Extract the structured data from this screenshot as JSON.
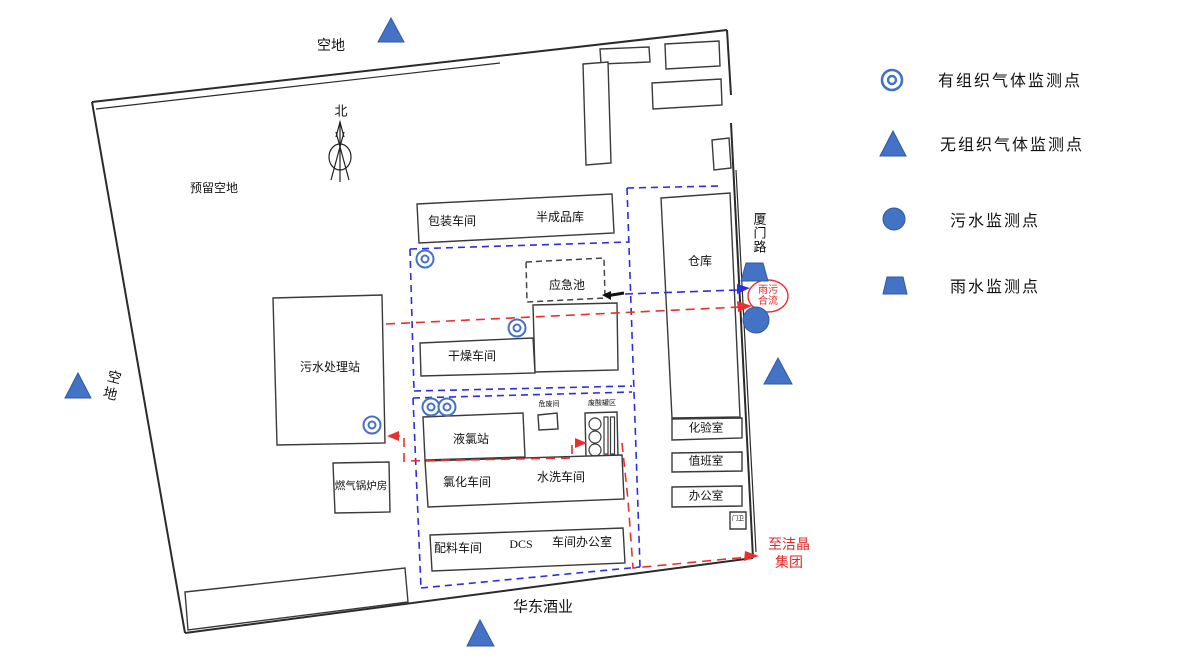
{
  "legend": {
    "items": [
      {
        "label": "有组织气体监测点",
        "icon": "organized-gas-point-icon"
      },
      {
        "label": "无组织气体监测点",
        "icon": "fugitive-gas-point-icon"
      },
      {
        "label": "污水监测点",
        "icon": "sewage-point-icon"
      },
      {
        "label": "雨水监测点",
        "icon": "rainwater-point-icon"
      }
    ]
  },
  "map": {
    "compass_label": "北",
    "open_space_top": "空地",
    "open_space_left": "空地",
    "reserved_space": "预留空地",
    "road": "厦门路",
    "neighbor_south": "华东酒业",
    "buildings": {
      "packaging": "包装车间",
      "semi_finished": "半成品库",
      "emergency_pool": "应急池",
      "drying": "干燥车间",
      "sewage_station": "污水处理站",
      "boiler_room": "燃气锅炉房",
      "chlorine_station": "液氯站",
      "hazwaste_room": "危废间",
      "acid_tank_area": "废酸罐区",
      "chlorination": "氯化车间",
      "washing": "水洗车间",
      "batching": "配料车间",
      "dcs": "DCS",
      "workshop_office": "车间办公室",
      "warehouse": "仓库",
      "lab": "化验室",
      "duty_room": "值班室",
      "office": "办公室",
      "gatehouse": "门卫"
    },
    "flows": {
      "rain_sewage_line1": "雨污",
      "rain_sewage_line2": "合流",
      "to_jiejing_line1": "至洁晶",
      "to_jiejing_line2": "集团"
    }
  },
  "colors": {
    "monitor_blue": "#4472C4",
    "monitor_blue_dark": "#2E5AA8",
    "pipe_blue": "#2d2de0",
    "pipe_red": "#e83030",
    "line_black": "#3a3a3a"
  }
}
